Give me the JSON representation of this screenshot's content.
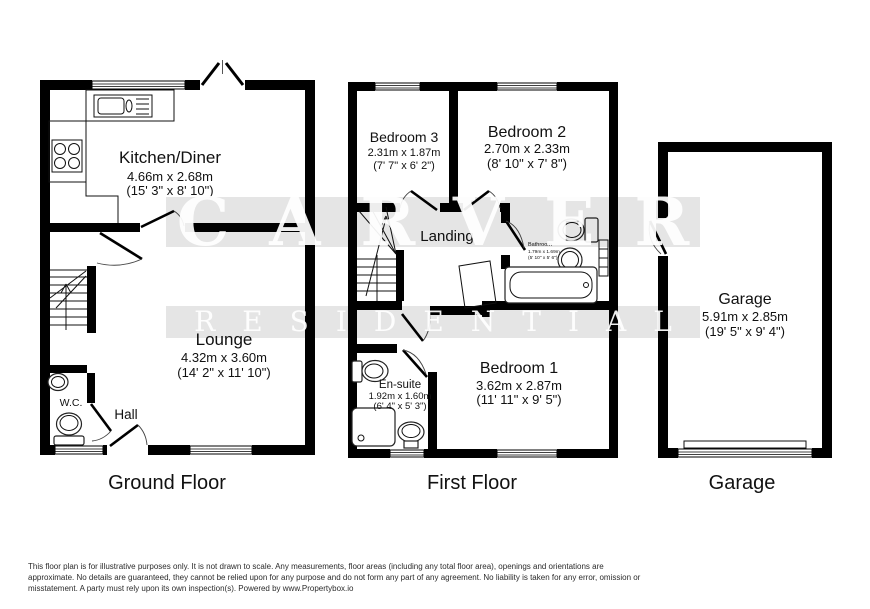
{
  "watermark": {
    "line1": "CARVER",
    "line2": "RESIDENTIAL",
    "band_color": "#e6e6e6",
    "text_color": "#ffffff"
  },
  "floors": {
    "ground": {
      "title": "Ground Floor",
      "rooms": {
        "kitchen": {
          "name": "Kitchen/Diner",
          "metric": "4.66m x 2.68m",
          "imperial": "(15' 3\" x 8' 10\")"
        },
        "lounge": {
          "name": "Lounge",
          "metric": "4.32m x 3.60m",
          "imperial": "(14' 2\" x 11' 10\")"
        },
        "wc": {
          "name": "W.C."
        },
        "hall": {
          "name": "Hall"
        }
      }
    },
    "first": {
      "title": "First Floor",
      "rooms": {
        "bedroom3": {
          "name": "Bedroom 3",
          "metric": "2.31m x 1.87m",
          "imperial": "(7' 7\" x 6' 2\")"
        },
        "bedroom2": {
          "name": "Bedroom 2",
          "metric": "2.70m x 2.33m",
          "imperial": "(8' 10\" x 7' 8\")"
        },
        "landing": {
          "name": "Landing"
        },
        "bathroom": {
          "name": "Bathroom",
          "metric": "1.79m x 1.69m",
          "imperial": "(5' 10\" x 5' 6\")"
        },
        "ensuite": {
          "name": "En-suite",
          "metric": "1.92m x 1.60m",
          "imperial": "(6' 4\" x 5' 3\")"
        },
        "bedroom1": {
          "name": "Bedroom 1",
          "metric": "3.62m x 2.87m",
          "imperial": "(11' 11\" x 9' 5\")"
        }
      }
    },
    "garage": {
      "title": "Garage",
      "rooms": {
        "garage": {
          "name": "Garage",
          "metric": "5.91m x 2.85m",
          "imperial": "(19' 5\" x 9' 4\")"
        }
      }
    }
  },
  "footer": {
    "line1": "This floor plan is for illustrative purposes only. It is not drawn to scale. Any measurements, floor areas (including any total floor area), openings and orientations are",
    "line2": "approximate. No details are guaranteed, they cannot be relied upon for any purpose and do not form any part of any agreement. No liability is taken for any error, omission or",
    "line3": "misstatement. A party must rely upon its own inspection(s). Powered by www.Propertybox.io"
  }
}
